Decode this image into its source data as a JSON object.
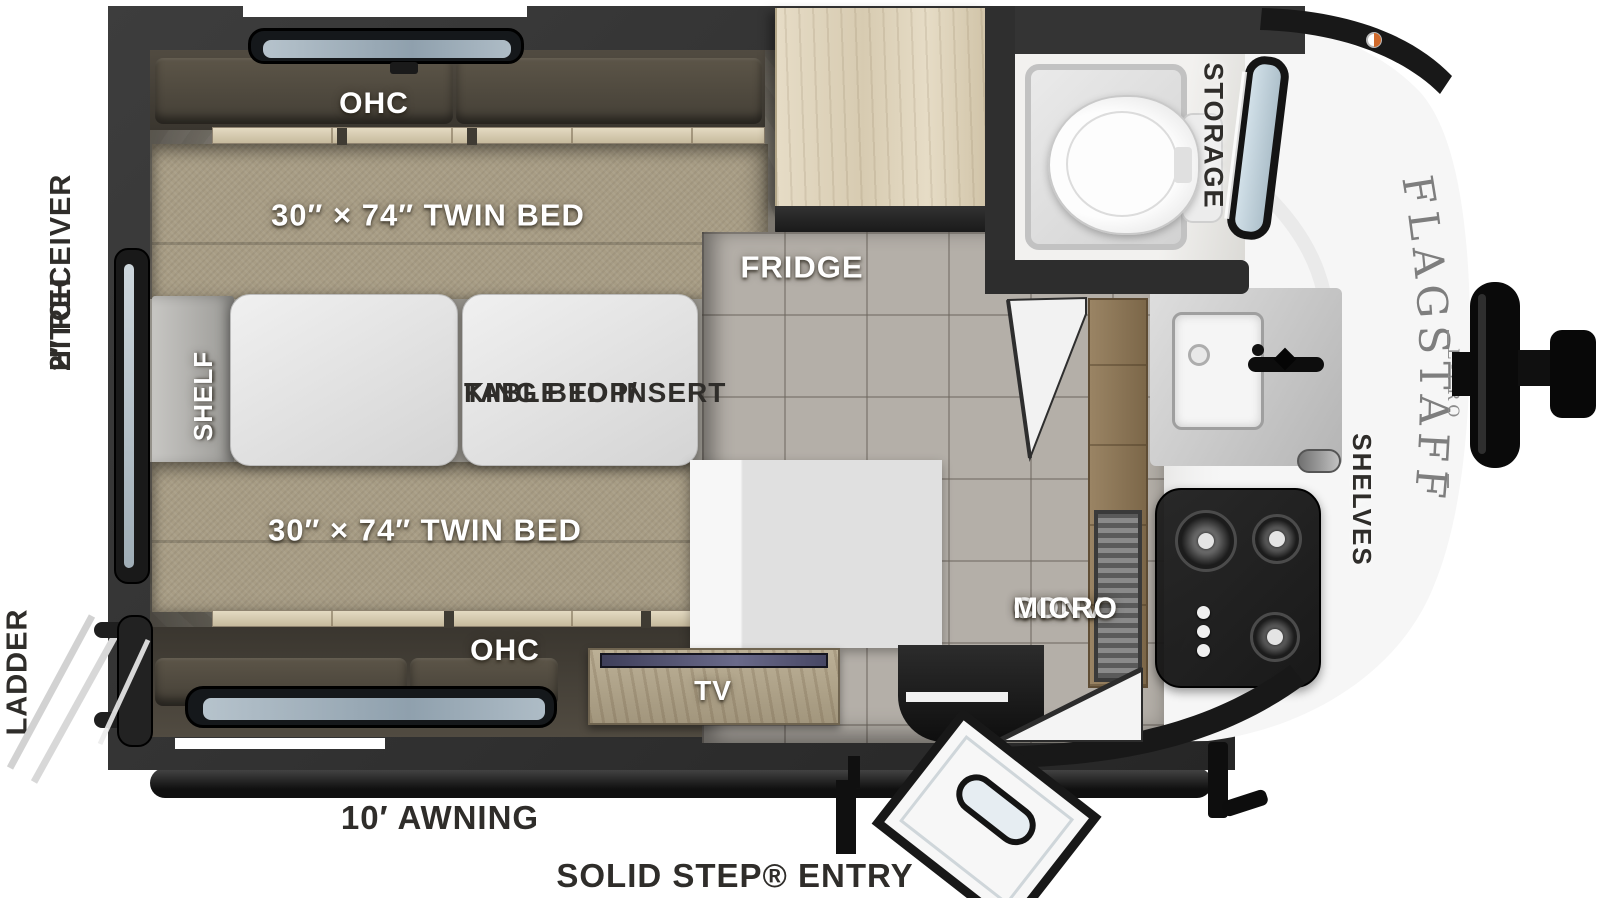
{
  "floorplan": {
    "brand": {
      "name": "FLAGSTAFF",
      "sub": "E-PRO"
    },
    "colors": {
      "wall": "#303030",
      "bed": "#a89d85",
      "wood_trim": "#d9ceb6",
      "tile_floor": "#b4afa8",
      "cap_white": "#f6f6f6",
      "appliance_black": "#141414",
      "label_white": "#ffffff",
      "label_black": "#2f2d2a"
    },
    "labels": {
      "ohc_top": "OHC",
      "twin_bed_top": "30″ × 74″ TWIN BED",
      "table_line1": "TABLE TOP/",
      "table_line2": "KING BED INSERT",
      "shelf": "SHELF",
      "twin_bed_bottom": "30″ × 74″ TWIN BED",
      "ohc_bottom": "OHC",
      "tv": "TV",
      "fridge": "FRIDGE",
      "storage": "STORAGE",
      "conv_line1": "CONV",
      "conv_line2": "MICRO",
      "shelves": "SHELVES",
      "hitch_line1": "2″ RECEIVER",
      "hitch_line2": "HITCH",
      "ladder": "LADDER",
      "awning": "10′ AWNING",
      "entry": "SOLID STEP® ENTRY"
    }
  }
}
